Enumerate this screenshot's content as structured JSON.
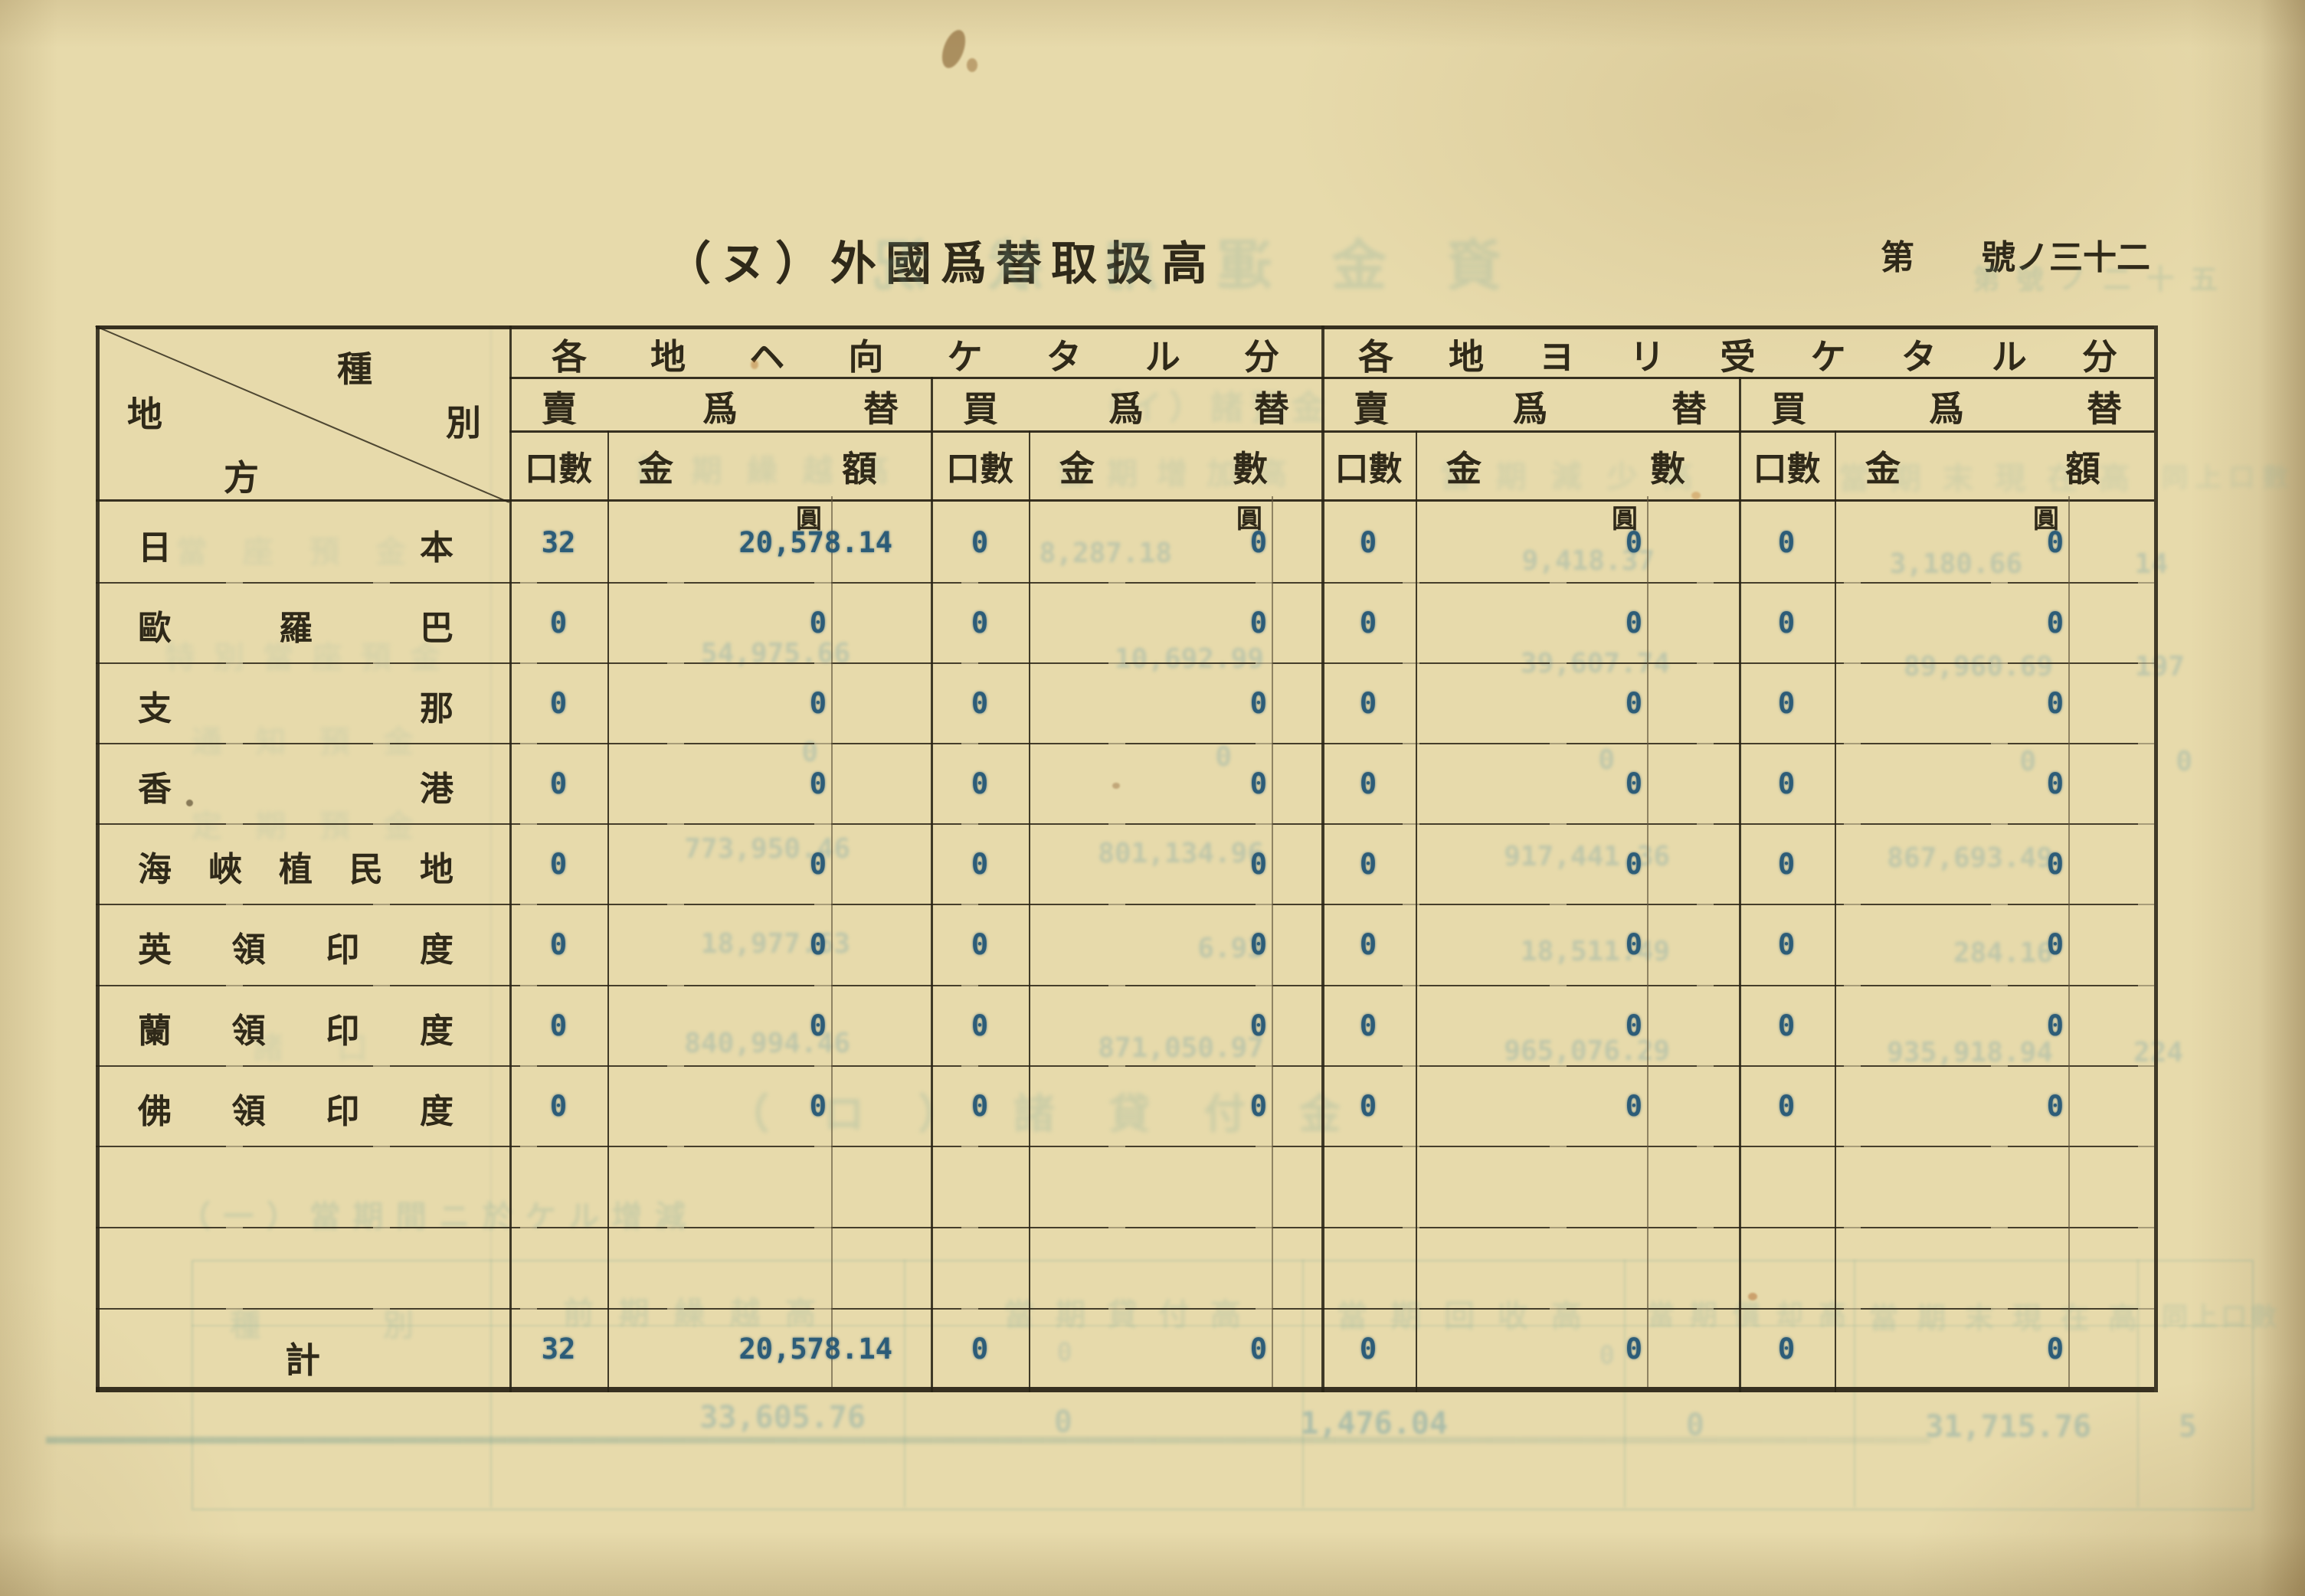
{
  "page": {
    "corner_prefix": "第",
    "corner_suffix": "號ノ三十二",
    "title": "（ヌ）外國爲替取扱高"
  },
  "table": {
    "corner_c1": "種",
    "corner_c2": "別",
    "corner_c3": "地",
    "corner_c4": "方",
    "unit": "圓",
    "groups": [
      {
        "title": "各地ヘ向ケタル分",
        "subs": [
          {
            "label": "賣爲替",
            "count": "口數",
            "amount": "金額"
          },
          {
            "label": "買爲替",
            "count": "口數",
            "amount": "金數"
          }
        ]
      },
      {
        "title": "各地ヨリ受ケタル分",
        "subs": [
          {
            "label": "賣爲替",
            "count": "口數",
            "amount": "金數"
          },
          {
            "label": "買爲替",
            "count": "口數",
            "amount": "金額"
          }
        ]
      }
    ],
    "rows": [
      {
        "region": "日本",
        "values": [
          "32",
          "20,578.14",
          "0",
          "0",
          "0",
          "0",
          "0",
          "0"
        ]
      },
      {
        "region": "歐羅巴",
        "values": [
          "0",
          "0",
          "0",
          "0",
          "0",
          "0",
          "0",
          "0"
        ]
      },
      {
        "region": "支那",
        "values": [
          "0",
          "0",
          "0",
          "0",
          "0",
          "0",
          "0",
          "0"
        ]
      },
      {
        "region": "香港",
        "values": [
          "0",
          "0",
          "0",
          "0",
          "0",
          "0",
          "0",
          "0"
        ]
      },
      {
        "region": "海峽植民地",
        "values": [
          "0",
          "0",
          "0",
          "0",
          "0",
          "0",
          "0",
          "0"
        ]
      },
      {
        "region": "英領印度",
        "values": [
          "0",
          "0",
          "0",
          "0",
          "0",
          "0",
          "0",
          "0"
        ]
      },
      {
        "region": "蘭領印度",
        "values": [
          "0",
          "0",
          "0",
          "0",
          "0",
          "0",
          "0",
          "0"
        ]
      },
      {
        "region": "佛領印度",
        "values": [
          "0",
          "0",
          "0",
          "0",
          "0",
          "0",
          "0",
          "0"
        ]
      },
      {
        "region": "",
        "values": [
          "",
          "",
          "",
          "",
          "",
          "",
          "",
          ""
        ]
      },
      {
        "region": "",
        "values": [
          "",
          "",
          "",
          "",
          "",
          "",
          "",
          ""
        ]
      }
    ],
    "total": {
      "label": "計",
      "values": [
        "32",
        "20,578.14",
        "0",
        "0",
        "0",
        "0",
        "0",
        "0"
      ]
    }
  },
  "ghosts": {
    "title_mirror": "資金運用狀況",
    "corner": "第號ノ二十五",
    "caption_i": "（イ）諸預金",
    "label_ghosts": [
      "當座預金",
      "特別當座預金",
      "通知預金",
      "定期預金",
      "諸口"
    ],
    "col_ghosts": [
      "前期繰越高",
      "當期增加高",
      "當期減少高",
      "當期末現在高",
      "同上口數"
    ],
    "caption_ro": "（ロ）諸貸付金",
    "caption_ichi": "（一）當期間ニ於ケル增減",
    "bottom_heads": [
      "種別",
      "前期繰越高",
      "當期貸付高",
      "當期回收高",
      "當期償却高",
      "當期末現在高",
      "同上口數"
    ],
    "row_numbers": [
      [
        "8,287.18",
        "9,418.37",
        "3,180.66",
        "14"
      ],
      [
        "54,975.66",
        "10,692.99",
        "39,607.74",
        "89,960.69",
        "197"
      ],
      [
        "0",
        "0",
        "0",
        "0",
        "0"
      ],
      [
        "773,950.46",
        "801,134.96",
        "917,441.36",
        "867,693.49"
      ],
      [
        "18,977.63",
        "6.93",
        "18,511.49",
        "284.16"
      ],
      [
        "840,994.46",
        "871,050.97",
        "965,076.29",
        "935,918.94",
        "224"
      ]
    ],
    "pre_total": [
      "0",
      "0",
      "0"
    ],
    "bottom_numbers": [
      "33,605.76",
      "0",
      "1,476.04",
      "0",
      "31,715.76",
      "5"
    ]
  }
}
